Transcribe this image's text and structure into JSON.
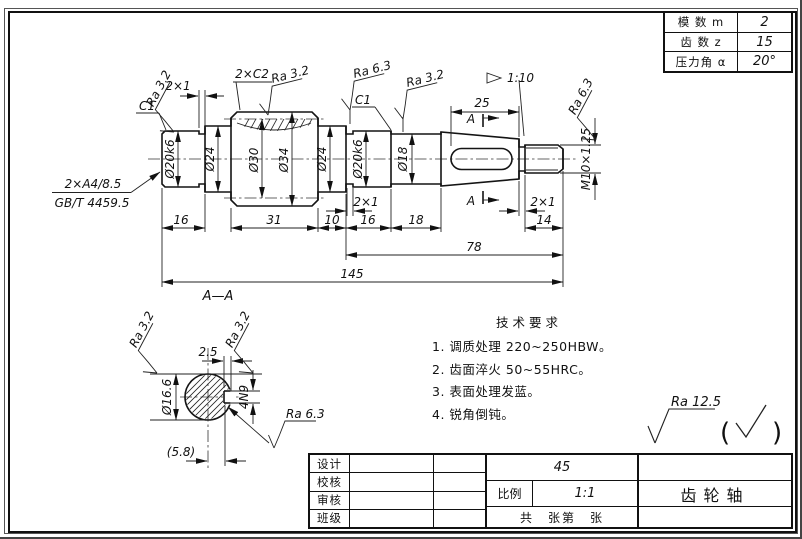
{
  "param_table": {
    "rows": [
      {
        "label": "模 数 m",
        "value": "2"
      },
      {
        "label": "齿 数 z",
        "value": "15"
      },
      {
        "label": "压力角 α",
        "value": "20°"
      }
    ]
  },
  "dims": {
    "seg16a": "16",
    "seg31": "31",
    "seg10": "10",
    "seg16b": "16",
    "seg18": "18",
    "seg14": "14",
    "total78": "78",
    "total145": "145",
    "keyway25": "25",
    "groove": "2×1",
    "chamfer": "C1",
    "gear_chamfer": "2×C2",
    "taper": "1:10",
    "thread": "M10×1.25",
    "dia20": "Ø20k6",
    "dia24": "Ø24",
    "dia30": "Ø30",
    "dia34": "Ø34",
    "dia18": "Ø18",
    "center_hole_line1": "2×A4/8.5",
    "center_hole_line2": "GB/T 4459.5"
  },
  "roughness": {
    "ra32": "Ra 3.2",
    "ra63": "Ra 6.3",
    "ra125": "Ra 12.5"
  },
  "rest_symbol": {
    "paren_open": "(",
    "paren_close": ")"
  },
  "section": {
    "title": "A—A",
    "dia": "Ø16.6",
    "key_width": "4N9",
    "key_depth": "2.5",
    "ref_dim": "(5.8)",
    "cut_label": "A"
  },
  "tech_req": {
    "title": "技术要求",
    "items": [
      "1. 调质处理 220~250HBW。",
      "2. 齿面淬火 50~55HRC。",
      "3. 表面处理发蓝。",
      "4. 锐角倒钝。"
    ]
  },
  "title_block": {
    "row_labels": [
      "设计",
      "校核",
      "审核",
      "班级"
    ],
    "material": "45",
    "scale_label": "比例",
    "scale_value": "1:1",
    "sheet_info": "共　张第　张",
    "part_name": "齿轮轴"
  }
}
